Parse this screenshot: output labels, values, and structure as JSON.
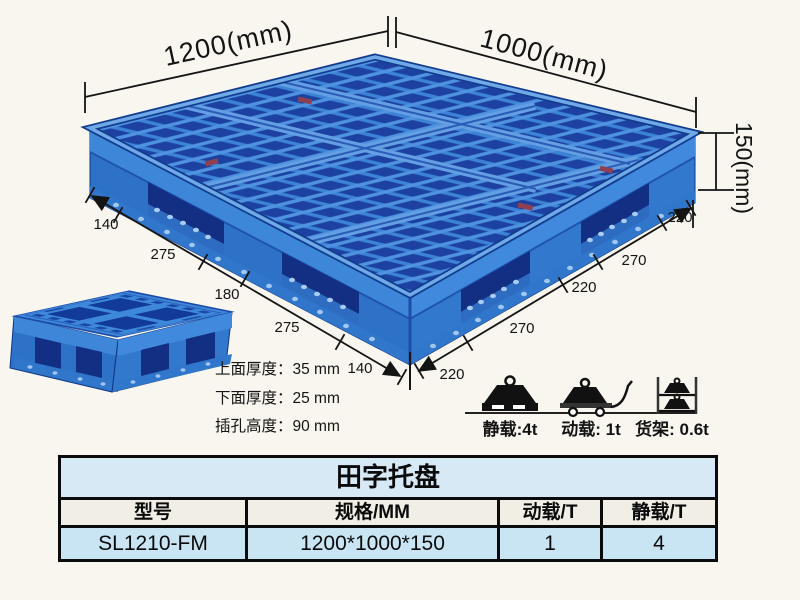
{
  "diagram": {
    "top_width_label": "1200(mm)",
    "top_depth_label": "1000(mm)",
    "height_label": "150(mm)",
    "left_edge_segments": [
      "140",
      "275",
      "180",
      "275",
      "140"
    ],
    "right_edge_segments": [
      "220",
      "270",
      "220",
      "270",
      "220"
    ],
    "thickness_notes": [
      "上面厚度：35 mm",
      "下面厚度：25 mm",
      "插孔高度：90 mm"
    ],
    "load_ratings": [
      {
        "icon": "weight-on-pallet",
        "label": "静载:4t"
      },
      {
        "icon": "weight-on-trolley",
        "label": "动载: 1t"
      },
      {
        "icon": "weights-on-rack",
        "label": "货架: 0.6t"
      }
    ]
  },
  "spec_table": {
    "title": "田字托盘",
    "columns": [
      "型号",
      "规格/MM",
      "动载/T",
      "静载/T"
    ],
    "rows": [
      [
        "SL1210-FM",
        "1200*1000*150",
        "1",
        "4"
      ]
    ]
  },
  "colors": {
    "background": "#f8f6ee",
    "pallet_blue": "#2e72c7",
    "pallet_blue_light": "#4f93e0",
    "pallet_blue_dark": "#16378f",
    "table_title_bg": "#d7e9f4",
    "table_header_bg": "#f1eee6",
    "table_data_bg": "#c9e4f2",
    "line_color": "#141414"
  }
}
